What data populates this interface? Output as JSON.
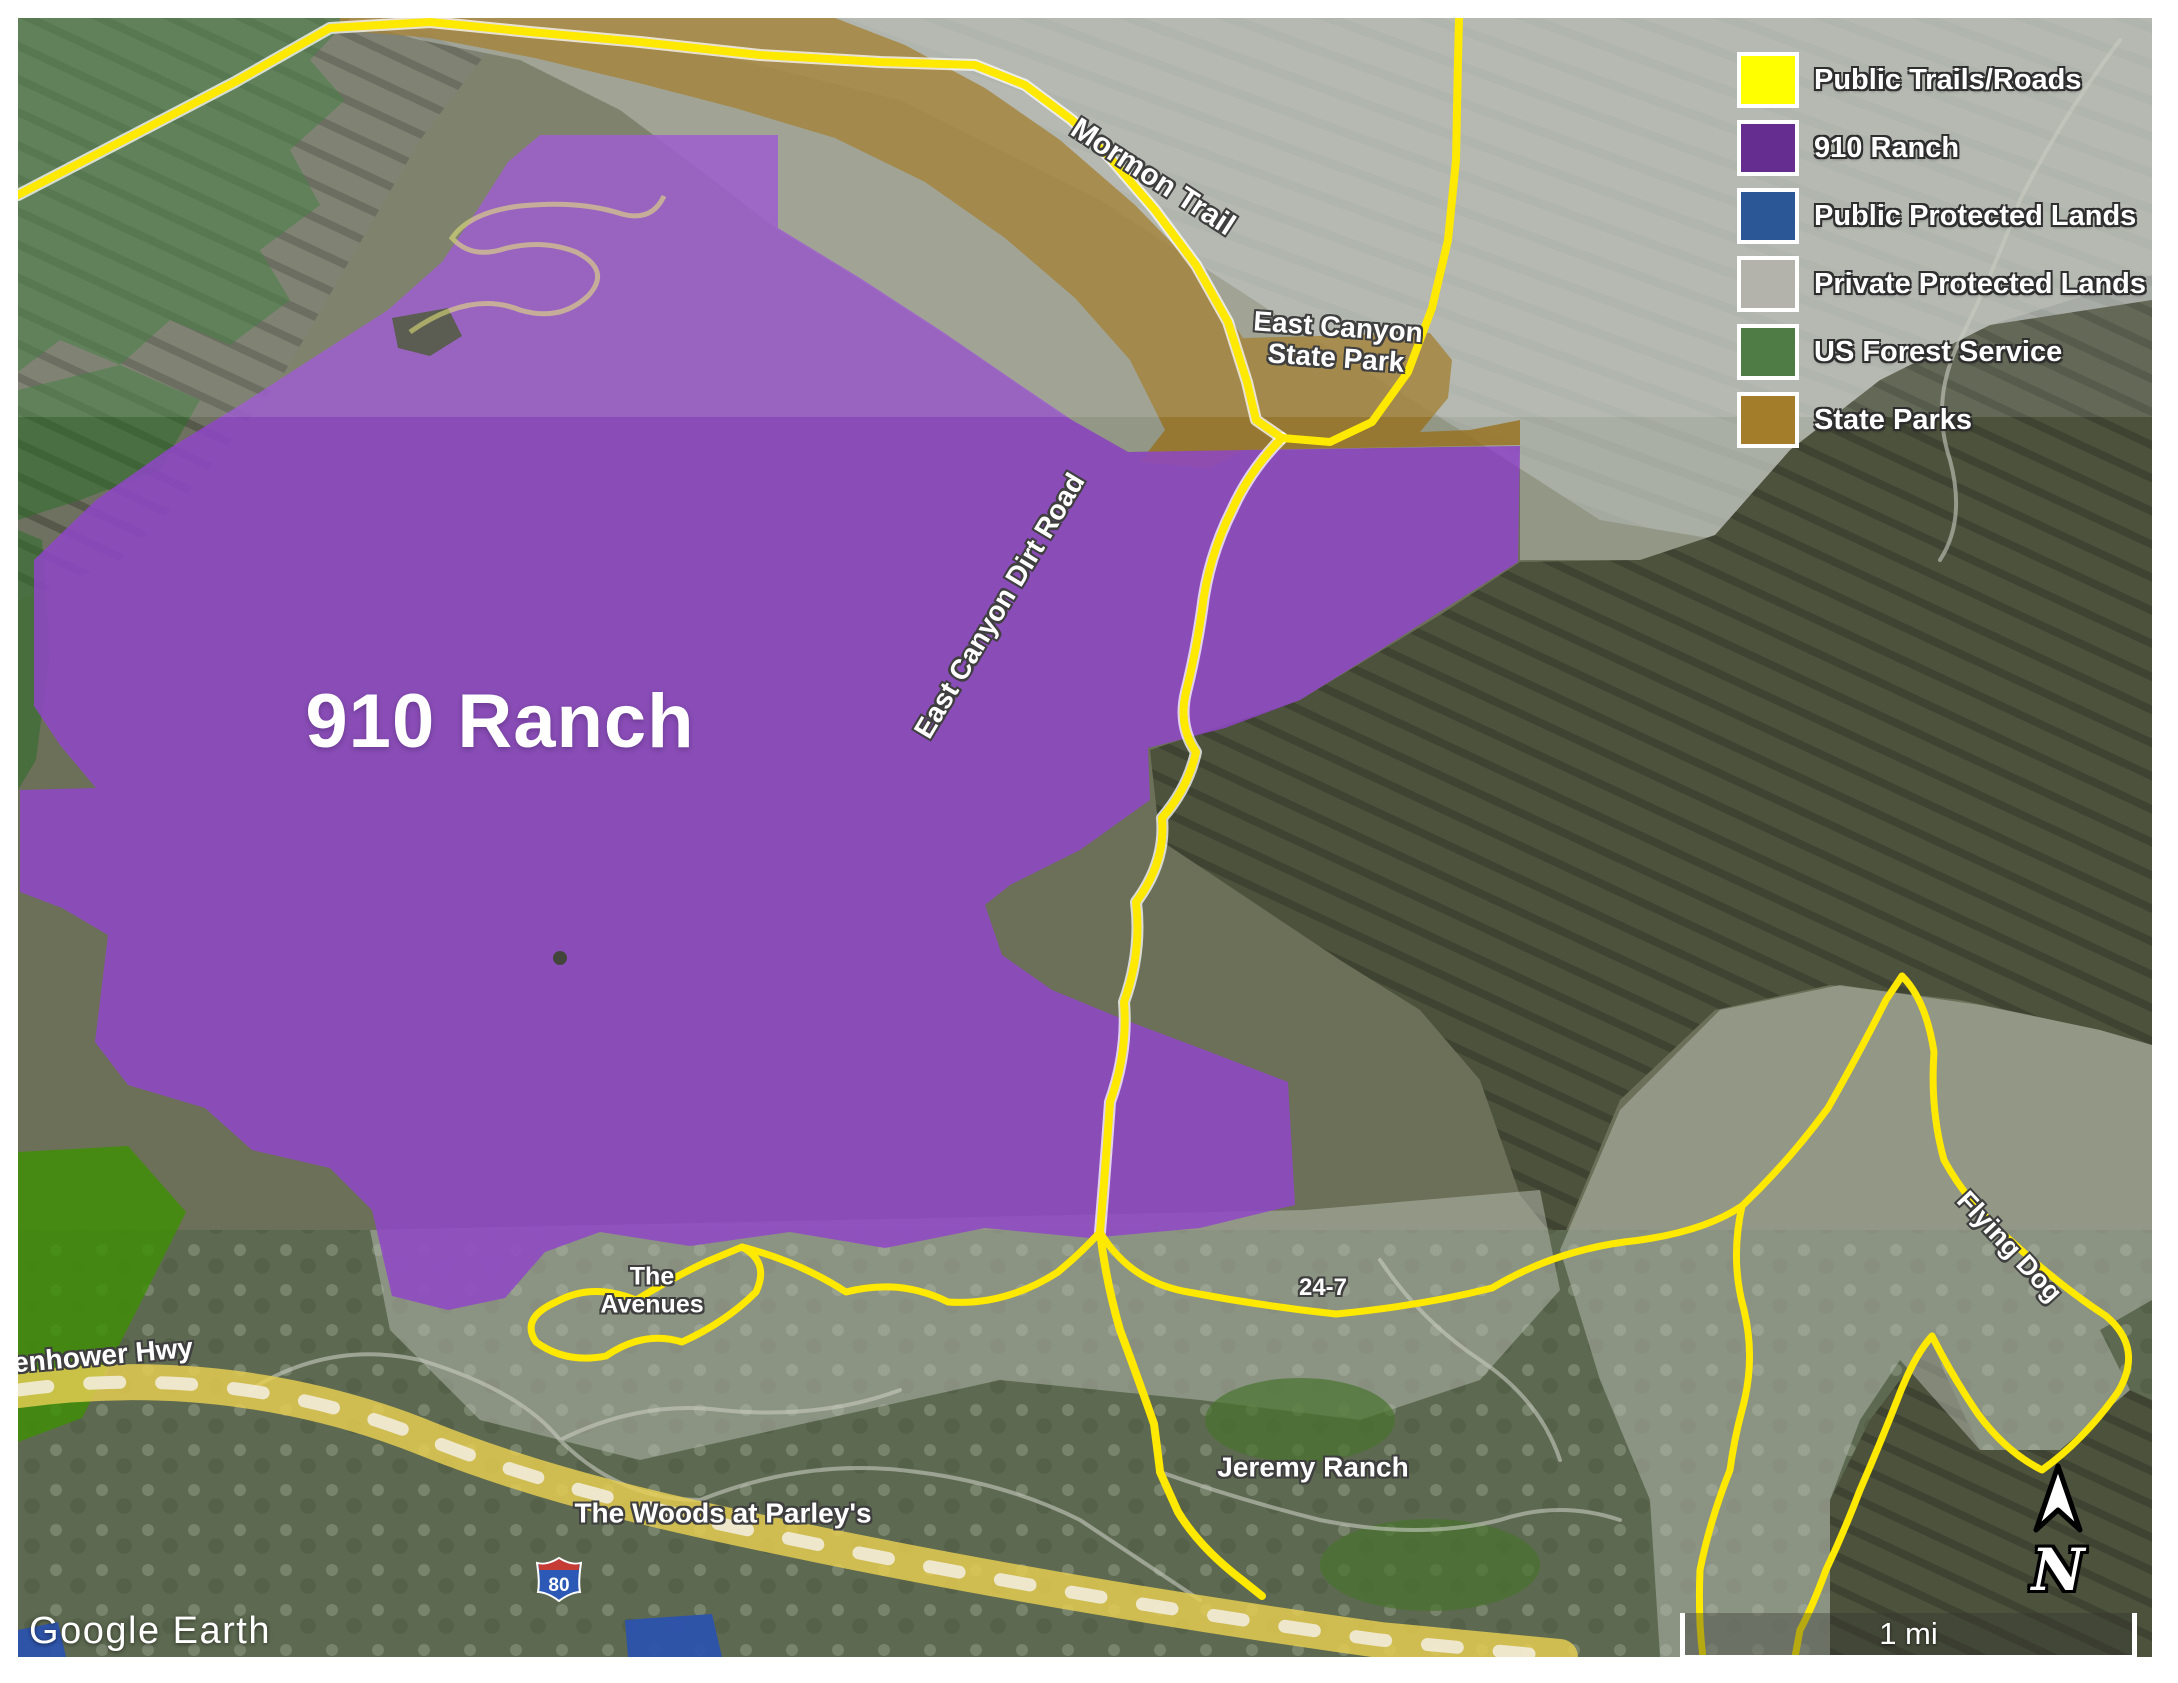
{
  "legend": {
    "items": [
      {
        "id": "public-trails-roads",
        "label": "Public Trails/Roads",
        "color": "#ffff00"
      },
      {
        "id": "910-ranch",
        "label": "910 Ranch",
        "color": "#662d91"
      },
      {
        "id": "public-protected-lands",
        "label": "Public Protected Lands",
        "color": "#2b5797"
      },
      {
        "id": "private-protected-lands",
        "label": "Private Protected Lands",
        "color": "#b3b2ab"
      },
      {
        "id": "us-forest-service",
        "label": "US Forest Service",
        "color": "#4f7b44"
      },
      {
        "id": "state-parks",
        "label": "State Parks",
        "color": "#a47d2b"
      }
    ]
  },
  "labels": [
    {
      "id": "910-ranch",
      "text": "910 Ranch",
      "x": 500,
      "y": 722,
      "size": 76,
      "rot": 0,
      "cls": "huge"
    },
    {
      "id": "mormon-trail",
      "text": "Mormon Trail",
      "x": 1153,
      "y": 177,
      "size": 30,
      "rot": 33,
      "cls": ""
    },
    {
      "id": "east-canyon-state-park",
      "text": "East Canyon\nState Park",
      "x": 1337,
      "y": 343,
      "size": 28,
      "rot": 4,
      "cls": ""
    },
    {
      "id": "east-canyon-dirt-road",
      "text": "East Canyon Dirt Road",
      "x": 1000,
      "y": 606,
      "size": 28,
      "rot": -59,
      "cls": ""
    },
    {
      "id": "the-avenues",
      "text": "The\nAvenues",
      "x": 652,
      "y": 1291,
      "size": 25,
      "rot": 0,
      "cls": ""
    },
    {
      "id": "24-7",
      "text": "24-7",
      "x": 1323,
      "y": 1288,
      "size": 24,
      "rot": 0,
      "cls": ""
    },
    {
      "id": "flying-dog",
      "text": "Flying Dog",
      "x": 2009,
      "y": 1247,
      "size": 27,
      "rot": 47,
      "cls": ""
    },
    {
      "id": "jeremy-ranch",
      "text": "Jeremy Ranch",
      "x": 1313,
      "y": 1468,
      "size": 28,
      "rot": 0,
      "cls": ""
    },
    {
      "id": "the-woods-at-parleys",
      "text": "The Woods at Parley's",
      "x": 723,
      "y": 1514,
      "size": 28,
      "rot": 0,
      "cls": ""
    },
    {
      "id": "eisenhower-hwy",
      "text": "enhower Hwy",
      "x": 103,
      "y": 1356,
      "size": 28,
      "rot": -5,
      "cls": ""
    },
    {
      "id": "google-earth-logo",
      "text": "Google Earth",
      "x": 150,
      "y": 1632,
      "size": 38,
      "rot": 0,
      "cls": "logo"
    }
  ],
  "scalebar": {
    "text": "1 mi"
  },
  "north": {
    "letter": "N"
  },
  "shield": {
    "route": "80"
  },
  "colors": {
    "trail_yellow": "#ffe900",
    "trail_casing": "#ffffff",
    "faint_trail": "#e9e97a",
    "highway_band": "#e8cf52",
    "highway_dash": "#f3efe0",
    "purple_fill": "#8f46c8",
    "brown_fill": "#97701d",
    "gray_fill": "#b9beb4",
    "green_fill": "#2d6e2a",
    "bright_green_fill": "#3f8e08",
    "blue_fill": "#2a52b0",
    "suburb_road": "#c8cbc0"
  }
}
